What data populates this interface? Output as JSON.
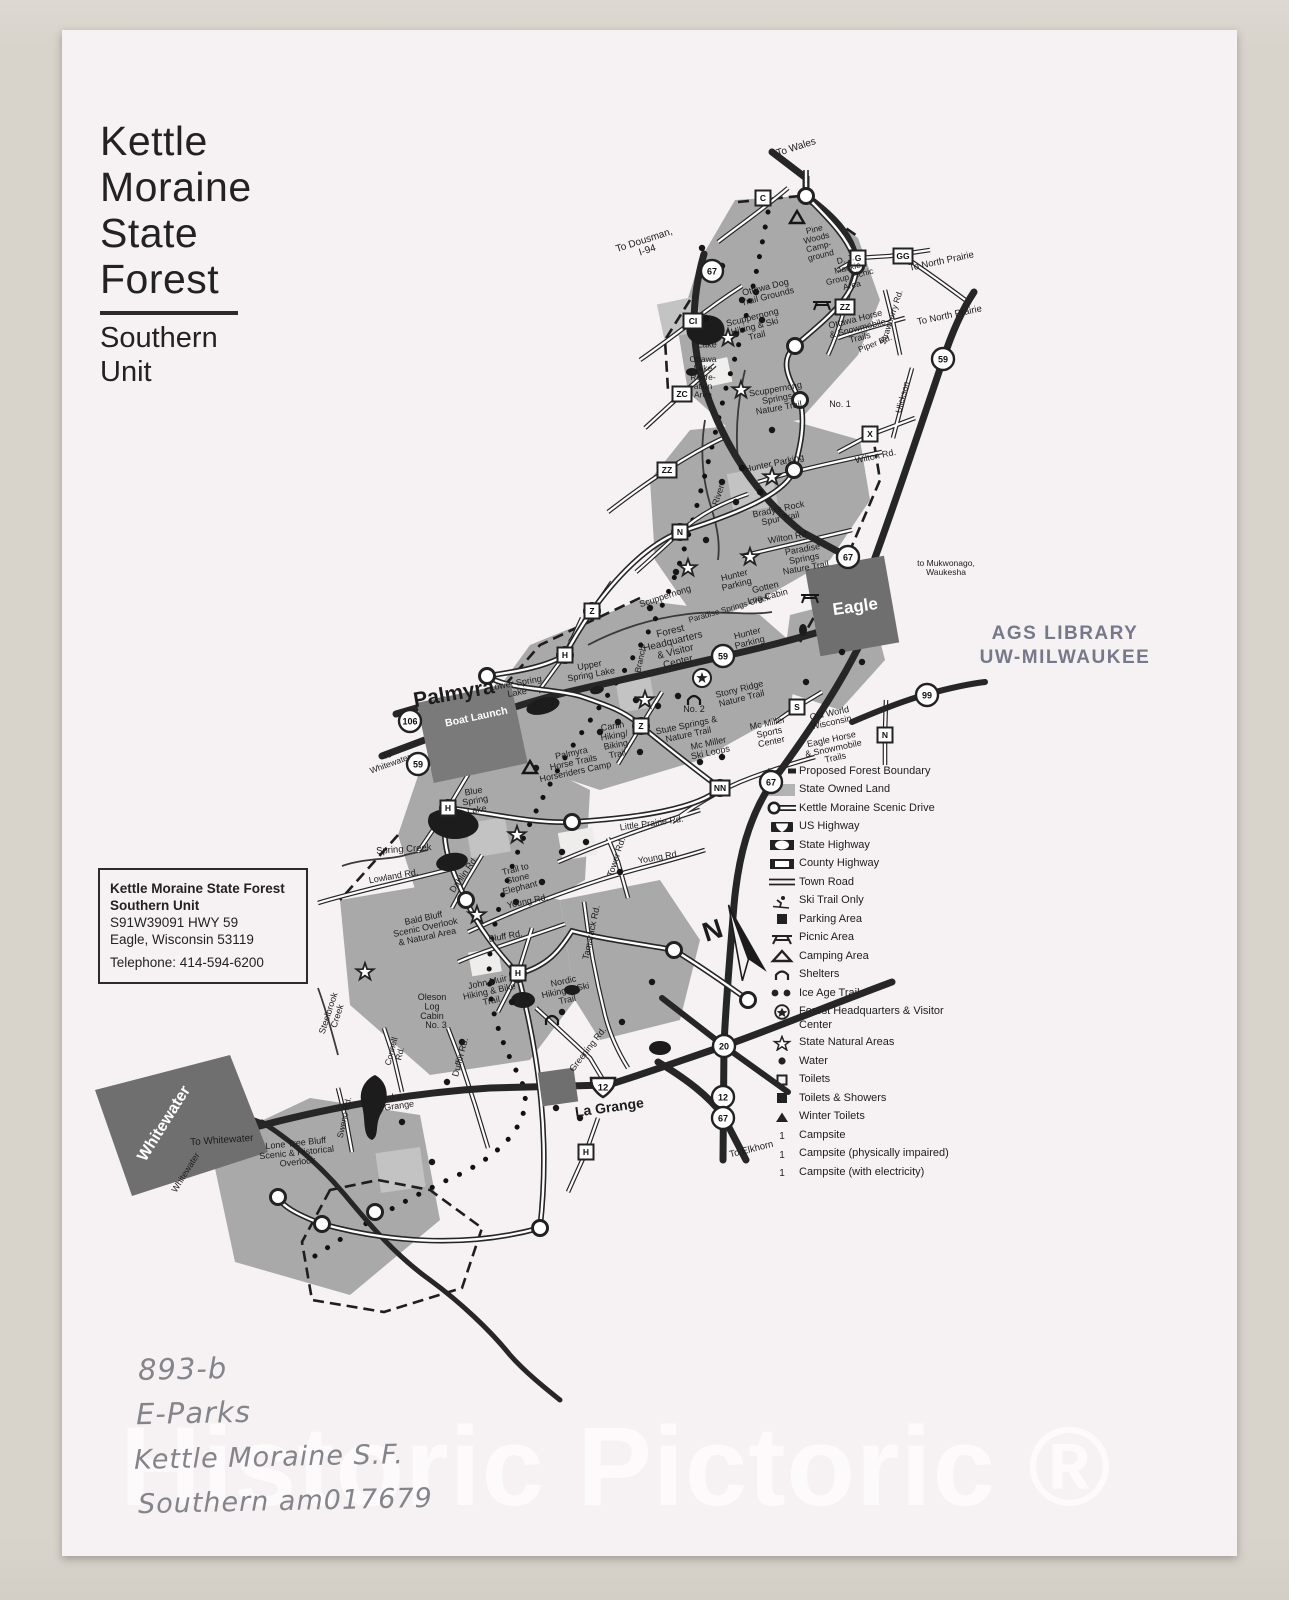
{
  "title_block": {
    "line1": "Kettle",
    "line2": "Moraine",
    "line3": "State",
    "line4": "Forest",
    "sub1": "Southern",
    "sub2": "Unit"
  },
  "address_box": {
    "name_line1": "Kettle Moraine State Forest",
    "name_line2": "Southern Unit",
    "address_line1": "S91W39091 HWY 59",
    "address_line2": "Eagle, Wisconsin 53119",
    "phone": "Telephone: 414-594-6200"
  },
  "stamp": {
    "line1": "AGS LIBRARY",
    "line2": "UW-MILWAUKEE"
  },
  "watermark": "Historic Pictoric ®",
  "annotations": {
    "handwriting": [
      "893-b",
      "E-Parks",
      "Kettle Moraine  S.F.",
      "Southern  am017679"
    ]
  },
  "legend": {
    "items": [
      {
        "icon": "dashed",
        "label": "Proposed Forest Boundary"
      },
      {
        "icon": "grayfill",
        "label": "State Owned Land"
      },
      {
        "icon": "scenic",
        "label": "Kettle Moraine Scenic Drive"
      },
      {
        "icon": "us",
        "label": "US Highway"
      },
      {
        "icon": "state",
        "label": "State Highway"
      },
      {
        "icon": "county",
        "label": "County Highway"
      },
      {
        "icon": "town",
        "label": "Town Road"
      },
      {
        "icon": "ski",
        "label": "Ski Trail Only"
      },
      {
        "icon": "parking",
        "label": "Parking Area"
      },
      {
        "icon": "picnic",
        "label": "Picnic Area"
      },
      {
        "icon": "camping",
        "label": "Camping Area"
      },
      {
        "icon": "shelter",
        "label": "Shelters"
      },
      {
        "icon": "iceage",
        "label": "Ice Age Trail"
      },
      {
        "icon": "hq",
        "label": "Forest Headquarters & Visitor Center"
      },
      {
        "icon": "star",
        "label": "State Natural Areas"
      },
      {
        "icon": "water",
        "label": "Water"
      },
      {
        "icon": "toilets",
        "label": "Toilets"
      },
      {
        "icon": "toiletsshowers",
        "label": "Toilets & Showers"
      },
      {
        "icon": "wintertoilets",
        "label": "Winter Toilets"
      },
      {
        "icon": "campsite",
        "label": "Campsite"
      },
      {
        "icon": "campsite",
        "label": "Campsite (physically impaired)"
      },
      {
        "icon": "campsite",
        "label": "Campsite (with electricity)"
      }
    ]
  },
  "map": {
    "compass_label": "N",
    "labels": [
      {
        "t": [
          "To Wales"
        ],
        "x": 797,
        "y": 150,
        "r": -18,
        "s": 10
      },
      {
        "t": [
          "To Dousman,",
          "I-94"
        ],
        "x": 645,
        "y": 243,
        "r": -18,
        "s": 10
      },
      {
        "t": [
          "To North Prairie"
        ],
        "x": 942,
        "y": 264,
        "r": -12,
        "s": 9.5
      },
      {
        "t": [
          "To North Prairie"
        ],
        "x": 950,
        "y": 318,
        "r": -12,
        "s": 9.5
      },
      {
        "t": [
          "Pine",
          "Woods",
          "Camp-",
          "ground"
        ],
        "x": 815,
        "y": 232,
        "r": -14,
        "s": 8.5
      },
      {
        "t": [
          "D. J.",
          "Mackie",
          "Group Picnic",
          "Area"
        ],
        "x": 846,
        "y": 262,
        "r": -14,
        "s": 8.5
      },
      {
        "t": [
          "Ottawa Dog",
          "Trail Grounds"
        ],
        "x": 766,
        "y": 290,
        "r": -14,
        "s": 9
      },
      {
        "t": [
          "Scuppernong",
          "Hiking & Ski",
          "Trail"
        ],
        "x": 753,
        "y": 320,
        "r": -14,
        "s": 9
      },
      {
        "t": [
          "Ottawa Horse",
          "& Snowmobile",
          "Trails"
        ],
        "x": 856,
        "y": 322,
        "r": -14,
        "s": 9
      },
      {
        "t": [
          "Ottawa",
          "Lake"
        ],
        "x": 707,
        "y": 338,
        "s": 9
      },
      {
        "t": [
          "Ottawa",
          "Lake",
          "Recre-",
          "ation",
          "Area"
        ],
        "x": 703,
        "y": 362,
        "s": 8.5
      },
      {
        "t": [
          "Piper Rd."
        ],
        "x": 876,
        "y": 346,
        "r": -22,
        "s": 8.5
      },
      {
        "t": [
          "Strawberry Rd."
        ],
        "x": 894,
        "y": 318,
        "r": -72,
        "s": 8.5
      },
      {
        "t": [
          "Ulickson"
        ],
        "x": 905,
        "y": 398,
        "r": -75,
        "s": 8.5
      },
      {
        "t": [
          "Scuppernong",
          "Springs",
          "Nature Trail"
        ],
        "x": 776,
        "y": 392,
        "r": -10,
        "s": 9
      },
      {
        "t": [
          "No. 1"
        ],
        "x": 840,
        "y": 407,
        "s": 9
      },
      {
        "t": [
          "Wilton Rd."
        ],
        "x": 876,
        "y": 459,
        "r": -12,
        "s": 9
      },
      {
        "t": [
          "Hunter Parking"
        ],
        "x": 775,
        "y": 466,
        "r": -12,
        "s": 9
      },
      {
        "t": [
          "River"
        ],
        "x": 721,
        "y": 496,
        "r": -72,
        "s": 9
      },
      {
        "t": [
          "Brady's Rock",
          "Spur Trail"
        ],
        "x": 779,
        "y": 512,
        "r": -12,
        "s": 9
      },
      {
        "t": [
          "Wilton Rd."
        ],
        "x": 789,
        "y": 540,
        "r": -10,
        "s": 9
      },
      {
        "t": [
          "Paradise",
          "Springs",
          "Nature Trail"
        ],
        "x": 803,
        "y": 552,
        "r": -10,
        "s": 9
      },
      {
        "t": [
          "Hunter",
          "Parking"
        ],
        "x": 735,
        "y": 578,
        "r": -14,
        "s": 9
      },
      {
        "t": [
          "Gotten",
          "Log Cabin"
        ],
        "x": 766,
        "y": 590,
        "r": -14,
        "s": 9
      },
      {
        "t": [
          "Scuppernong"
        ],
        "x": 666,
        "y": 599,
        "r": -18,
        "s": 9
      },
      {
        "t": [
          "Paradise Springs  Creek"
        ],
        "x": 730,
        "y": 611,
        "r": -16,
        "s": 8
      },
      {
        "t": [
          "Forest",
          "Headquarters",
          "& Visitor",
          "Center"
        ],
        "x": 671,
        "y": 634,
        "r": -14,
        "s": 10
      },
      {
        "t": [
          "Hunter",
          "Parking"
        ],
        "x": 748,
        "y": 636,
        "r": -14,
        "s": 9
      },
      {
        "t": [
          "Branch"
        ],
        "x": 643,
        "y": 660,
        "r": -78,
        "s": 8.5
      },
      {
        "t": [
          "to Mukwonago,",
          "Waukesha"
        ],
        "x": 946,
        "y": 566,
        "s": 8.5
      },
      {
        "t": [
          "Eagle"
        ],
        "x": 856,
        "y": 612,
        "r": -8,
        "s": 17,
        "w": 1
      },
      {
        "t": [
          "Upper",
          "Spring Lake"
        ],
        "x": 590,
        "y": 668,
        "r": -10,
        "s": 9
      },
      {
        "t": [
          "Lower Spring",
          "Lake"
        ],
        "x": 516,
        "y": 686,
        "r": -10,
        "s": 9
      },
      {
        "t": [
          "Palmyra"
        ],
        "x": 455,
        "y": 700,
        "r": -10,
        "s": 21
      },
      {
        "t": [
          "Boat Launch"
        ],
        "x": 477,
        "y": 720,
        "r": -12,
        "s": 10.5,
        "w": 1
      },
      {
        "t": [
          "Stony Ridge",
          "Nature Trail"
        ],
        "x": 740,
        "y": 692,
        "r": -14,
        "s": 9
      },
      {
        "t": [
          "No. 2"
        ],
        "x": 694,
        "y": 712,
        "s": 9
      },
      {
        "t": [
          "Stute Springs &",
          "Nature Trail"
        ],
        "x": 687,
        "y": 728,
        "r": -12,
        "s": 9
      },
      {
        "t": [
          "Carlin",
          "Hiking/",
          "Biking",
          "Trail"
        ],
        "x": 613,
        "y": 729,
        "r": -10,
        "s": 9
      },
      {
        "t": [
          "Mc Miller",
          "Ski Loops"
        ],
        "x": 709,
        "y": 746,
        "r": -12,
        "s": 9
      },
      {
        "t": [
          "Mc Miller",
          "Sports",
          "Center"
        ],
        "x": 768,
        "y": 726,
        "r": -12,
        "s": 9
      },
      {
        "t": [
          "Old World",
          "Wisconsin"
        ],
        "x": 830,
        "y": 716,
        "r": -12,
        "s": 9
      },
      {
        "t": [
          "Eagle Horse",
          "& Snowmobile",
          "Trails"
        ],
        "x": 832,
        "y": 742,
        "r": -12,
        "s": 9
      },
      {
        "t": [
          "Palmyra",
          "Horse Trails",
          "Horseriders Camp"
        ],
        "x": 572,
        "y": 756,
        "r": -12,
        "s": 9
      },
      {
        "t": [
          "To",
          "Whitewater"
        ],
        "x": 388,
        "y": 758,
        "r": -20,
        "s": 8.5
      },
      {
        "t": [
          "Blue",
          "Spring",
          "Lake"
        ],
        "x": 474,
        "y": 794,
        "r": -10,
        "s": 9
      },
      {
        "t": [
          "Little Prairie Rd."
        ],
        "x": 652,
        "y": 826,
        "r": -8,
        "s": 9
      },
      {
        "t": [
          "Spring Creek"
        ],
        "x": 404,
        "y": 852,
        "r": -4,
        "s": 9.5
      },
      {
        "t": [
          "Lowland Rd."
        ],
        "x": 394,
        "y": 879,
        "r": -10,
        "s": 9
      },
      {
        "t": [
          "Dahlin Rd."
        ],
        "x": 466,
        "y": 876,
        "r": -55,
        "s": 9
      },
      {
        "t": [
          "Trail to",
          "Stone",
          "Elephant"
        ],
        "x": 516,
        "y": 872,
        "r": -14,
        "s": 9
      },
      {
        "t": [
          "Young Rd."
        ],
        "x": 528,
        "y": 904,
        "r": -12,
        "s": 9
      },
      {
        "t": [
          "Young Rd."
        ],
        "x": 659,
        "y": 860,
        "r": -10,
        "s": 9
      },
      {
        "t": [
          "Tower Rd."
        ],
        "x": 619,
        "y": 858,
        "r": -72,
        "s": 9
      },
      {
        "t": [
          "Bald Bluff",
          "Scenic Overlook",
          "& Natural Area"
        ],
        "x": 424,
        "y": 921,
        "r": -12,
        "s": 9
      },
      {
        "t": [
          "Bluff Rd."
        ],
        "x": 506,
        "y": 939,
        "r": -10,
        "s": 9
      },
      {
        "t": [
          "John Muir",
          "Hiking & Bike",
          "Trail"
        ],
        "x": 488,
        "y": 985,
        "r": -12,
        "s": 9
      },
      {
        "t": [
          "Nordic",
          "Hiking & Ski",
          "Trail"
        ],
        "x": 564,
        "y": 984,
        "r": -12,
        "s": 9
      },
      {
        "t": [
          "Tamarack Rd."
        ],
        "x": 594,
        "y": 933,
        "r": -78,
        "s": 9
      },
      {
        "t": [
          "Oleson",
          "Log",
          "Cabin"
        ],
        "x": 432,
        "y": 1000,
        "s": 9
      },
      {
        "t": [
          "No. 3"
        ],
        "x": 436,
        "y": 1028,
        "s": 9
      },
      {
        "t": [
          "Steelbrook",
          "Creek"
        ],
        "x": 331,
        "y": 1014,
        "r": -72,
        "s": 9
      },
      {
        "t": [
          "Connell",
          "Rd."
        ],
        "x": 394,
        "y": 1052,
        "r": -75,
        "s": 8.5
      },
      {
        "t": [
          "Duffin Rd."
        ],
        "x": 463,
        "y": 1058,
        "r": -75,
        "s": 9
      },
      {
        "t": [
          "Greening Rd."
        ],
        "x": 590,
        "y": 1051,
        "r": -52,
        "s": 9
      },
      {
        "t": [
          "Lake",
          "La Grange"
        ],
        "x": 392,
        "y": 1100,
        "r": -8,
        "s": 9
      },
      {
        "t": [
          "La Grange"
        ],
        "x": 610,
        "y": 1112,
        "r": -8,
        "s": 14
      },
      {
        "t": [
          "To Elkhorn"
        ],
        "x": 752,
        "y": 1152,
        "r": -14,
        "s": 9.5
      },
      {
        "t": [
          "To Whitewater"
        ],
        "x": 222,
        "y": 1143,
        "r": -4,
        "s": 10
      },
      {
        "t": [
          "Whitewater"
        ],
        "x": 168,
        "y": 1126,
        "r": -58,
        "s": 16,
        "w": 1
      },
      {
        "t": [
          "Whitewater"
        ],
        "x": 188,
        "y": 1174,
        "r": -58,
        "s": 9
      },
      {
        "t": [
          "Lone Tree Bluff",
          "Scenic & Historical",
          "Overlook"
        ],
        "x": 296,
        "y": 1146,
        "r": -6,
        "s": 9
      },
      {
        "t": [
          "Sweno Rd."
        ],
        "x": 347,
        "y": 1118,
        "r": -78,
        "s": 8.5
      }
    ],
    "state_circles": [
      {
        "n": "67",
        "x": 712,
        "y": 271
      },
      {
        "n": "59",
        "x": 943,
        "y": 359
      },
      {
        "n": "67",
        "x": 848,
        "y": 557
      },
      {
        "n": "59",
        "x": 723,
        "y": 656
      },
      {
        "n": "106",
        "x": 410,
        "y": 721
      },
      {
        "n": "59",
        "x": 418,
        "y": 764
      },
      {
        "n": "99",
        "x": 927,
        "y": 695
      },
      {
        "n": "67",
        "x": 771,
        "y": 782
      },
      {
        "n": "20",
        "x": 724,
        "y": 1046
      },
      {
        "n": "12",
        "x": 723,
        "y": 1097
      },
      {
        "n": "67",
        "x": 723,
        "y": 1118
      }
    ],
    "us_shields": [
      {
        "n": "12",
        "x": 603,
        "y": 1087
      }
    ],
    "county_boxes": [
      {
        "n": "C",
        "x": 763,
        "y": 198
      },
      {
        "n": "G",
        "x": 858,
        "y": 258
      },
      {
        "n": "GG",
        "x": 903,
        "y": 256
      },
      {
        "n": "ZZ",
        "x": 845,
        "y": 307
      },
      {
        "n": "CI",
        "x": 693,
        "y": 321
      },
      {
        "n": "ZC",
        "x": 682,
        "y": 394
      },
      {
        "n": "ZZ",
        "x": 667,
        "y": 470
      },
      {
        "n": "X",
        "x": 870,
        "y": 434
      },
      {
        "n": "N",
        "x": 680,
        "y": 532
      },
      {
        "n": "Z",
        "x": 592,
        "y": 611
      },
      {
        "n": "H",
        "x": 565,
        "y": 655
      },
      {
        "n": "Z",
        "x": 641,
        "y": 726
      },
      {
        "n": "H",
        "x": 448,
        "y": 808
      },
      {
        "n": "S",
        "x": 797,
        "y": 707
      },
      {
        "n": "N",
        "x": 885,
        "y": 735
      },
      {
        "n": "NN",
        "x": 720,
        "y": 788
      },
      {
        "n": "H",
        "x": 518,
        "y": 973
      },
      {
        "n": "H",
        "x": 586,
        "y": 1152
      }
    ],
    "scenic_nodes": [
      [
        806,
        196
      ],
      [
        856,
        266
      ],
      [
        795,
        346
      ],
      [
        800,
        400
      ],
      [
        794,
        470
      ],
      [
        680,
        532
      ],
      [
        592,
        611
      ],
      [
        565,
        655
      ],
      [
        487,
        676
      ],
      [
        641,
        726
      ],
      [
        720,
        788
      ],
      [
        572,
        822
      ],
      [
        448,
        808
      ],
      [
        466,
        900
      ],
      [
        518,
        974
      ],
      [
        674,
        950
      ],
      [
        748,
        1000
      ],
      [
        278,
        1197
      ],
      [
        322,
        1224
      ],
      [
        375,
        1212
      ],
      [
        540,
        1228
      ]
    ],
    "stars": [
      [
        728,
        338
      ],
      [
        741,
        390
      ],
      [
        772,
        477
      ],
      [
        688,
        568
      ],
      [
        750,
        557
      ],
      [
        645,
        700
      ],
      [
        517,
        835
      ],
      [
        477,
        915
      ],
      [
        365,
        972
      ]
    ],
    "hq_marker": [
      702,
      678
    ],
    "water_dots": [
      [
        702,
        248
      ],
      [
        722,
        266
      ],
      [
        742,
        300
      ],
      [
        706,
        318
      ],
      [
        756,
        292
      ],
      [
        762,
        320
      ],
      [
        736,
        334
      ],
      [
        772,
        430
      ],
      [
        742,
        468
      ],
      [
        722,
        482
      ],
      [
        760,
        492
      ],
      [
        736,
        502
      ],
      [
        706,
        540
      ],
      [
        676,
        572
      ],
      [
        650,
        608
      ],
      [
        636,
        700
      ],
      [
        658,
        706
      ],
      [
        678,
        696
      ],
      [
        618,
        722
      ],
      [
        600,
        732
      ],
      [
        640,
        752
      ],
      [
        700,
        762
      ],
      [
        722,
        757
      ],
      [
        586,
        842
      ],
      [
        562,
        852
      ],
      [
        620,
        872
      ],
      [
        516,
        902
      ],
      [
        542,
        882
      ],
      [
        492,
        982
      ],
      [
        512,
        1002
      ],
      [
        462,
        1042
      ],
      [
        447,
        1082
      ],
      [
        402,
        1122
      ],
      [
        432,
        1162
      ],
      [
        562,
        1012
      ],
      [
        622,
        1022
      ],
      [
        652,
        982
      ],
      [
        842,
        652
      ],
      [
        862,
        662
      ],
      [
        806,
        682
      ],
      [
        536,
        768
      ],
      [
        556,
        1108
      ],
      [
        580,
        1118
      ]
    ],
    "picnic_icons": [
      [
        822,
        305
      ],
      [
        810,
        598
      ]
    ],
    "camp_icons": [
      [
        797,
        218
      ],
      [
        530,
        768
      ]
    ],
    "shelter_icons": [
      [
        694,
        700
      ],
      [
        552,
        1020
      ]
    ]
  }
}
